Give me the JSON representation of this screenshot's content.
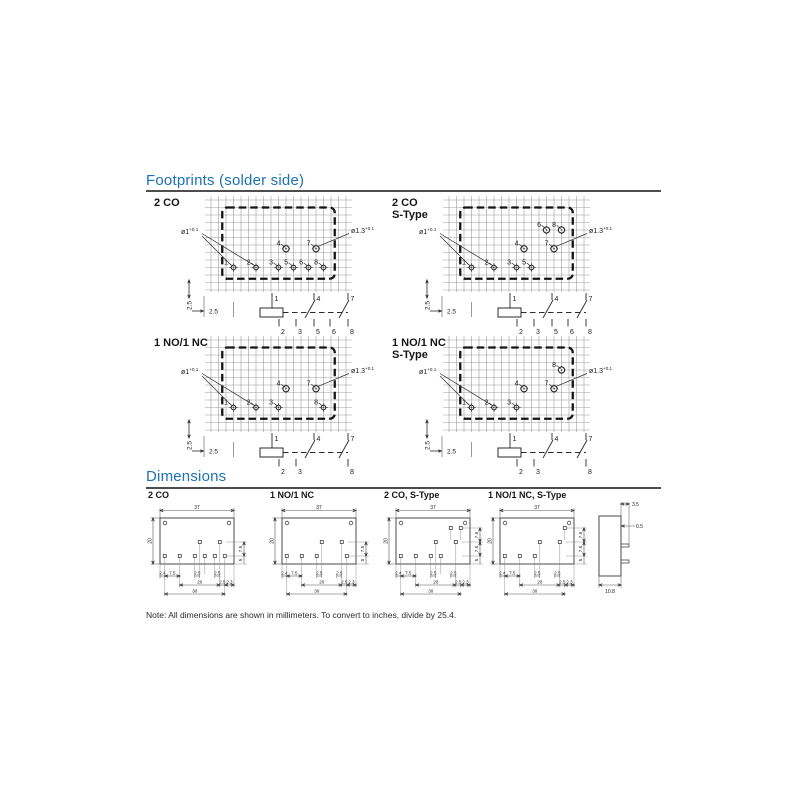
{
  "titles": {
    "footprints": "Footprints (solder side)",
    "dimensions": "Dimensions"
  },
  "note": "Note: All dimensions are shown in millimeters. To convert to inches, divide by 25.4.",
  "colors": {
    "accent": "#1d71b5",
    "rule": "#4d4d4d",
    "ink": "#1a1a1a",
    "grid": "#9d9d9d"
  },
  "footprints": [
    {
      "label": "2 CO",
      "sublabel": "",
      "hole_small": "ø1",
      "hole_small_tol": "+0.1",
      "hole_large": "ø1.3",
      "hole_large_tol": "+0.1",
      "dim_vertical": "2.5",
      "dim_horizontal": "2.5",
      "pins": [
        {
          "n": "1",
          "col": 3,
          "row": "b",
          "big": false
        },
        {
          "n": "2",
          "col": 6,
          "row": "b",
          "big": false
        },
        {
          "n": "3",
          "col": 9,
          "row": "b",
          "big": false
        },
        {
          "n": "5",
          "col": 11,
          "row": "b",
          "big": false
        },
        {
          "n": "6",
          "col": 13,
          "row": "b",
          "big": false
        },
        {
          "n": "8",
          "col": 15,
          "row": "b",
          "big": false
        },
        {
          "n": "4",
          "col": 10,
          "row": "m",
          "big": true
        },
        {
          "n": "7",
          "col": 14,
          "row": "m",
          "big": true
        }
      ],
      "schematic": {
        "top": [
          "1",
          "4",
          "7"
        ],
        "bottom": [
          "2",
          "3",
          "5",
          "6",
          "8"
        ]
      }
    },
    {
      "label": "2 CO",
      "sublabel": "S-Type",
      "hole_small": "ø1",
      "hole_small_tol": "+0.1",
      "hole_large": "ø1.3",
      "hole_large_tol": "+0.1",
      "dim_vertical": "2.5",
      "dim_horizontal": "2.5",
      "pins": [
        {
          "n": "1",
          "col": 3,
          "row": "b",
          "big": false
        },
        {
          "n": "2",
          "col": 6,
          "row": "b",
          "big": false
        },
        {
          "n": "3",
          "col": 9,
          "row": "b",
          "big": false
        },
        {
          "n": "5",
          "col": 11,
          "row": "b",
          "big": false
        },
        {
          "n": "4",
          "col": 10,
          "row": "m",
          "big": true
        },
        {
          "n": "7",
          "col": 14,
          "row": "m",
          "big": true
        },
        {
          "n": "6",
          "col": 13,
          "row": "t",
          "big": true
        },
        {
          "n": "8",
          "col": 15,
          "row": "t",
          "big": true
        }
      ],
      "schematic": {
        "top": [
          "1",
          "4",
          "7"
        ],
        "bottom": [
          "2",
          "3",
          "5",
          "6",
          "8"
        ]
      }
    },
    {
      "label": "1 NO/1 NC",
      "sublabel": "",
      "hole_small": "ø1",
      "hole_small_tol": "+0.1",
      "hole_large": "ø1.3",
      "hole_large_tol": "+0.1",
      "dim_vertical": "2.5",
      "dim_horizontal": "2.5",
      "pins": [
        {
          "n": "1",
          "col": 3,
          "row": "b",
          "big": false
        },
        {
          "n": "2",
          "col": 6,
          "row": "b",
          "big": false
        },
        {
          "n": "3",
          "col": 9,
          "row": "b",
          "big": false
        },
        {
          "n": "8",
          "col": 15,
          "row": "b",
          "big": false
        },
        {
          "n": "4",
          "col": 10,
          "row": "m",
          "big": true
        },
        {
          "n": "7",
          "col": 14,
          "row": "m",
          "big": true
        }
      ],
      "schematic": {
        "top": [
          "1",
          "4",
          "7"
        ],
        "bottom": [
          "2",
          "3",
          "8"
        ]
      }
    },
    {
      "label": "1 NO/1 NC",
      "sublabel": "S-Type",
      "hole_small": "ø1",
      "hole_small_tol": "+0.1",
      "hole_large": "ø1.3",
      "hole_large_tol": "+0.1",
      "dim_vertical": "2.5",
      "dim_horizontal": "2.5",
      "pins": [
        {
          "n": "1",
          "col": 3,
          "row": "b",
          "big": false
        },
        {
          "n": "2",
          "col": 6,
          "row": "b",
          "big": false
        },
        {
          "n": "3",
          "col": 9,
          "row": "b",
          "big": false
        },
        {
          "n": "4",
          "col": 10,
          "row": "m",
          "big": true
        },
        {
          "n": "7",
          "col": 14,
          "row": "m",
          "big": true
        },
        {
          "n": "8",
          "col": 15,
          "row": "t",
          "big": true
        }
      ],
      "schematic": {
        "top": [
          "1",
          "4",
          "7"
        ],
        "bottom": [
          "2",
          "3",
          "8"
        ]
      }
    }
  ],
  "dimension_drawings": [
    {
      "label": "2 CO",
      "body_width": "37",
      "body_height": "20",
      "right_dims": [
        "7.5",
        "5"
      ],
      "bottom_row1": [
        "2.4",
        "7.5",
        "2.5",
        "2.5"
      ],
      "bottom_row2": [
        "20",
        "2.5",
        "2.3"
      ],
      "bottom_row3": [
        "30"
      ],
      "pins_bottom": [
        "1",
        "2",
        "3",
        "5",
        "6",
        "8"
      ],
      "pins_middle": [
        "4",
        "7"
      ],
      "pins_top": []
    },
    {
      "label": "1 NO/1 NC",
      "body_width": "37",
      "body_height": "20",
      "right_dims": [
        "7.5",
        "5"
      ],
      "bottom_row1": [
        "2.4",
        "7.5",
        "2.5",
        "2.5"
      ],
      "bottom_row2": [
        "20",
        "2.5",
        "2.3"
      ],
      "bottom_row3": [
        "30"
      ],
      "pins_bottom": [
        "1",
        "2",
        "3",
        "8"
      ],
      "pins_middle": [
        "4",
        "7"
      ],
      "pins_top": []
    },
    {
      "label": "2 CO, S-Type",
      "body_width": "37",
      "body_height": "20",
      "right_dims": [
        "7.5",
        "7.5",
        "5"
      ],
      "bottom_row1": [
        "2.4",
        "7.5",
        "2.5",
        "2.5"
      ],
      "bottom_row2": [
        "20",
        "2.5",
        "2.3"
      ],
      "bottom_row3": [
        "30"
      ],
      "pins_bottom": [
        "1",
        "2",
        "3",
        "5"
      ],
      "pins_middle": [
        "4",
        "7"
      ],
      "pins_top": [
        "6",
        "8"
      ]
    },
    {
      "label": "1 NO/1 NC, S-Type",
      "body_width": "37",
      "body_height": "20",
      "right_dims": [
        "7.5",
        "7.5",
        "5"
      ],
      "bottom_row1": [
        "2.4",
        "7.5",
        "2.5",
        "2.5"
      ],
      "bottom_row2": [
        "20",
        "2.5",
        "2.3"
      ],
      "bottom_row3": [
        "30"
      ],
      "pins_bottom": [
        "1",
        "2",
        "3"
      ],
      "pins_middle": [
        "4",
        "7"
      ],
      "pins_top": [
        "8"
      ]
    }
  ],
  "side_view": {
    "dim_top": "3.5",
    "dim_pin": "0.5",
    "dim_depth": "10.8"
  }
}
